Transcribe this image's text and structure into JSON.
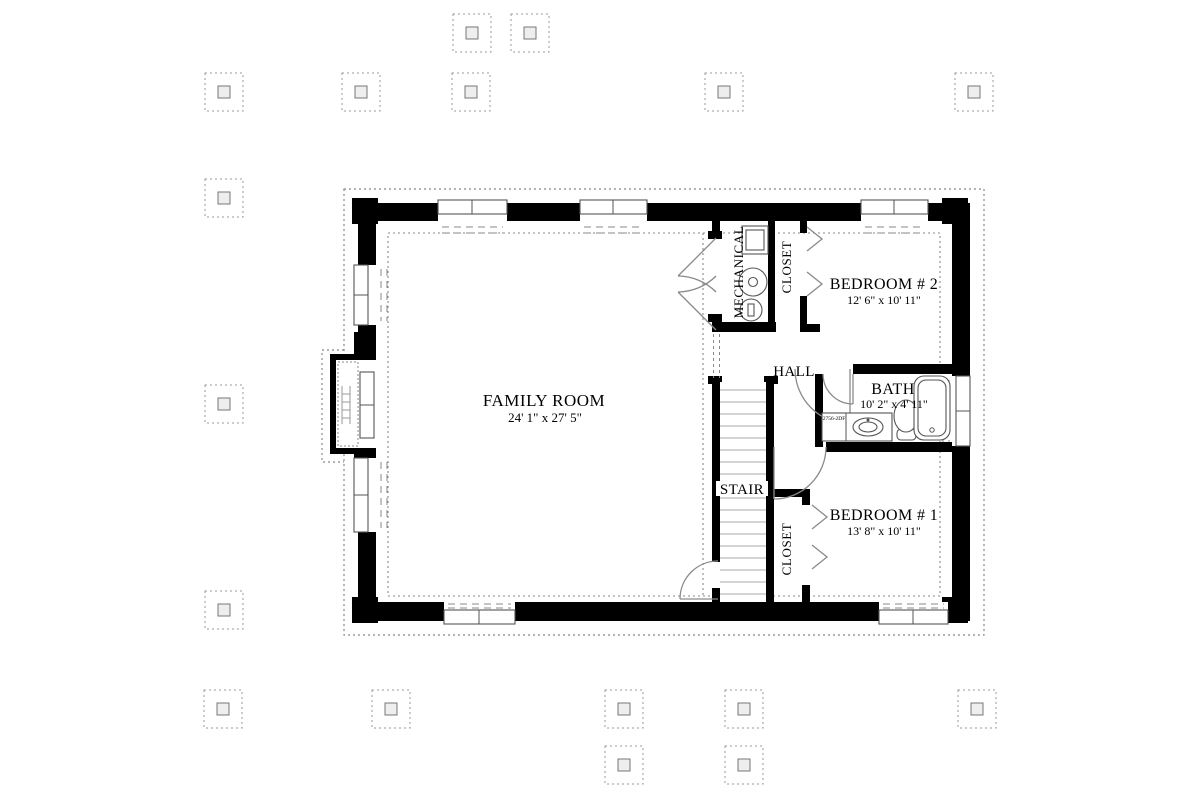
{
  "plan": {
    "rooms": {
      "family_room": {
        "label": "FAMILY ROOM",
        "dimensions": "24' 1\" x 27' 5\""
      },
      "bedroom_2": {
        "label": "BEDROOM # 2",
        "dimensions": "12' 6\" x 10' 11\""
      },
      "bedroom_1": {
        "label": "BEDROOM # 1",
        "dimensions": "13' 8\" x 10' 11\""
      },
      "bath": {
        "label": "BATH",
        "dimensions": "10' 2\" x 4' 11\""
      },
      "hall": {
        "label": "HALL"
      },
      "stair": {
        "label": "STAIR"
      },
      "closet_upper": {
        "label": "CLOSET"
      },
      "closet_lower": {
        "label": "CLOSET"
      },
      "mechanical": {
        "label": "MECHANICAL"
      }
    },
    "fixtures": {
      "vanity_code": "2756-2DF",
      "bath_items": [
        "vanity-sink",
        "toilet",
        "bathtub"
      ],
      "mechanical_items": [
        "water-heater",
        "furnace",
        "sump-pump"
      ],
      "left_wall_item": "egress-window-well"
    },
    "symbols": {
      "footing_posts_count": 17,
      "window_count": 8,
      "swing_doors": 5,
      "bifold_doors": 2
    },
    "colors": {
      "wall": "#000000",
      "fixture_line": "#555555",
      "door_line": "#8a8a8a",
      "dashed_line": "#888888",
      "post_line": "#999999",
      "text": "#000000",
      "background": "#ffffff"
    }
  }
}
